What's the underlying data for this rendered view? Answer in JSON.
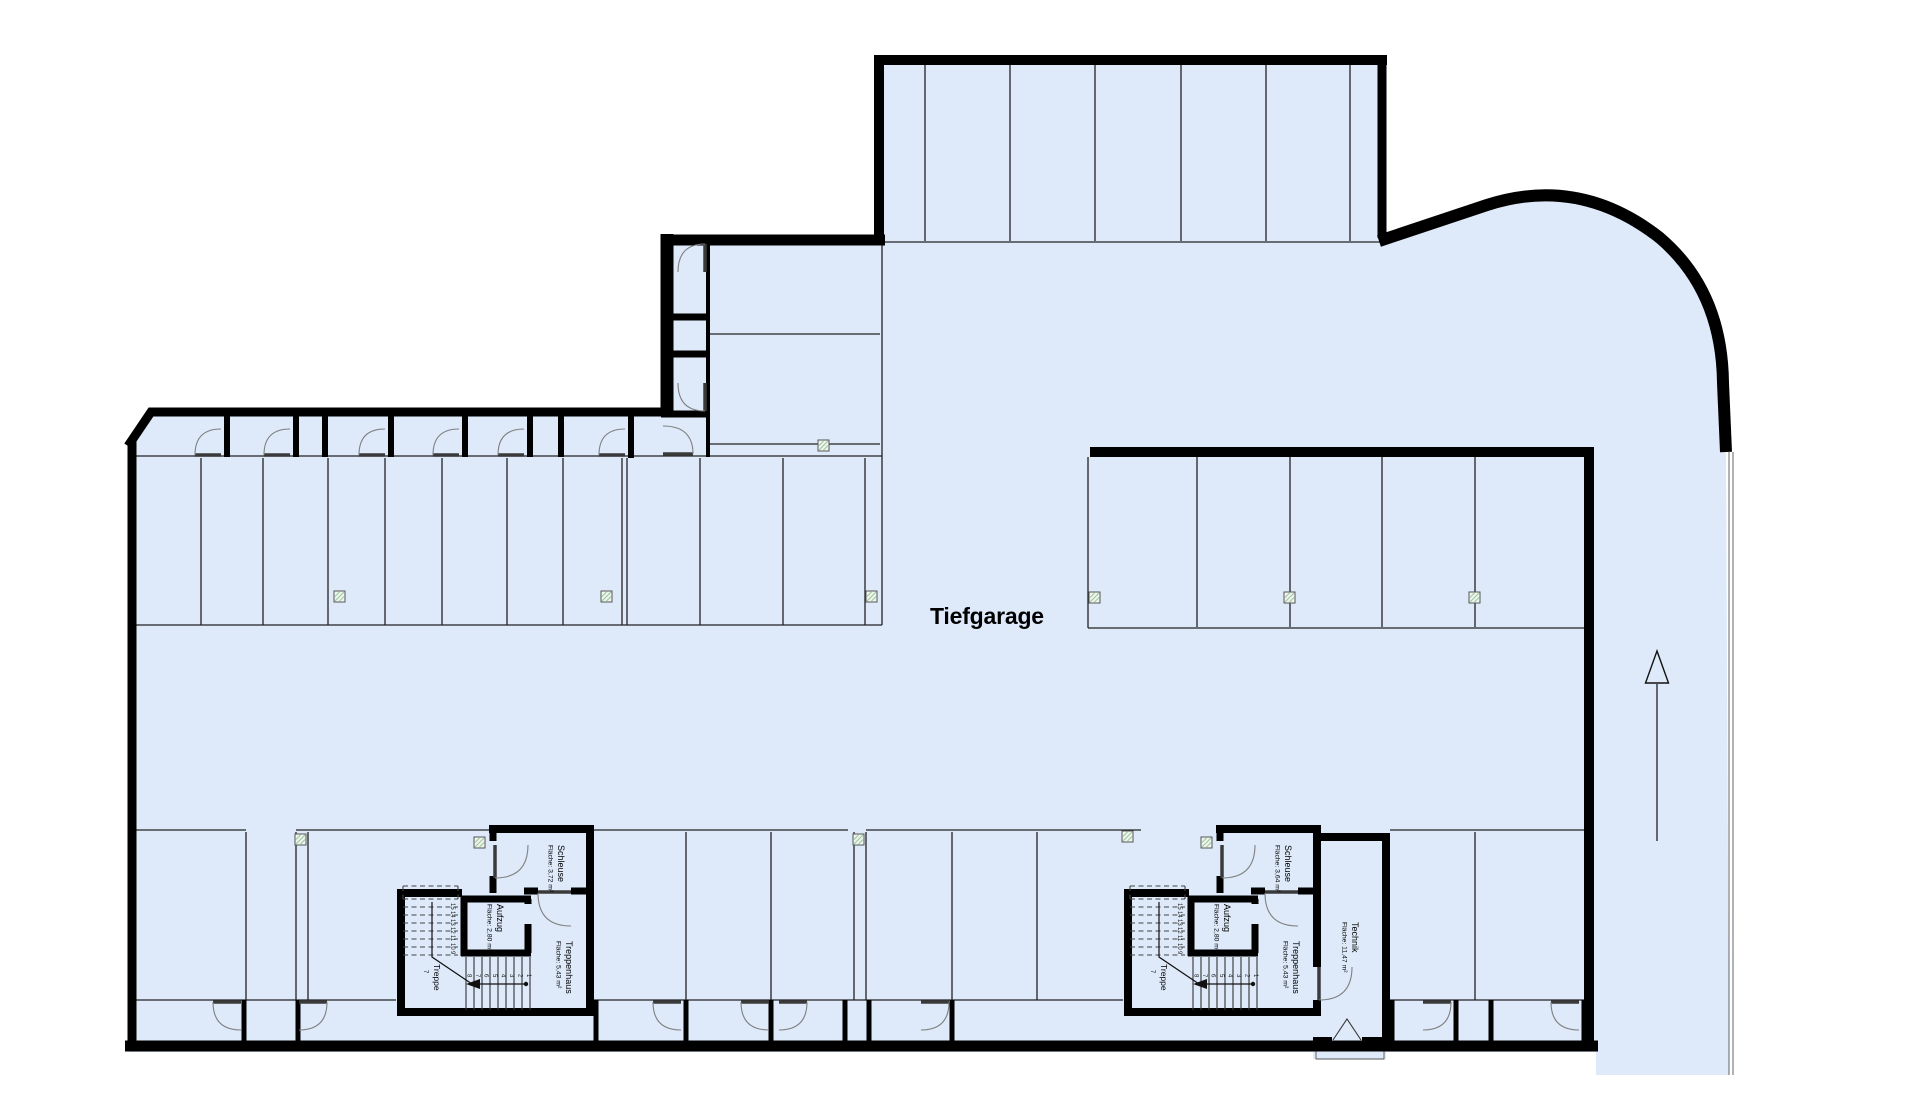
{
  "title": "Tiefgarage",
  "colors": {
    "floor": "#deeafa",
    "wall": "#000000",
    "thin_line": "#232323",
    "door_arc": "#808080",
    "column_hatch": "#9cc49c"
  },
  "icons": {
    "ramp_arrow": "up-arrow",
    "column": "hatched-column-square"
  },
  "cores": {
    "left": {
      "schleuse_name": "Schleuse",
      "schleuse_area": "Fläche: 3,72 m²",
      "aufzug_name": "Aufzug",
      "aufzug_area": "Fläche: 2,80 m²",
      "treppenhaus_name": "Treppenhaus",
      "treppenhaus_area": "Fläche: 5,43 m²"
    },
    "right": {
      "schleuse_name": "Schleuse",
      "schleuse_area": "Fläche: 3,64 m²",
      "aufzug_name": "Aufzug",
      "aufzug_area": "Fläche: 2,80 m²",
      "treppenhaus_name": "Treppenhaus",
      "treppenhaus_area": "Fläche: 5,43 m²",
      "technik_name": "Technik",
      "technik_area": "Fläche: 11,47 m²"
    }
  },
  "stair": {
    "label": "Treppe",
    "mid_number": "7",
    "lower": [
      "1",
      "2",
      "3",
      "4",
      "5",
      "6",
      "7",
      "8"
    ],
    "upper": [
      "9",
      "10",
      "11",
      "12",
      "13",
      "14",
      "15"
    ]
  }
}
